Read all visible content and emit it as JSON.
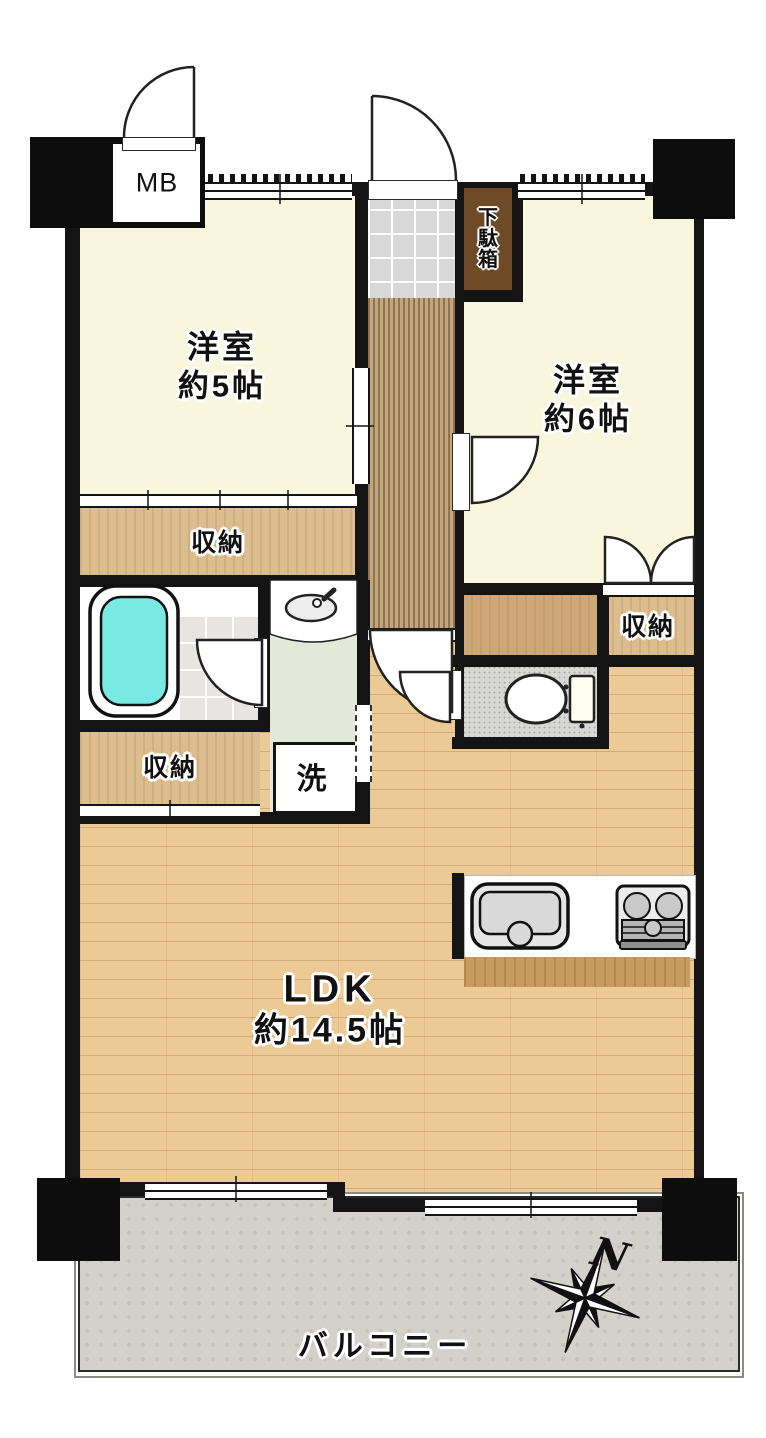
{
  "plan": {
    "title": "2LDK apartment floor plan",
    "mb_label": "MB",
    "entrance": {
      "shoe_cabinet_label": "下駄箱"
    },
    "rooms": {
      "west_room_5": {
        "name": "洋室",
        "size": "約5帖"
      },
      "west_room_6": {
        "name": "洋室",
        "size": "約6帖"
      },
      "ldk": {
        "name": "LDK",
        "size": "約14.5帖"
      },
      "laundry_label": "洗",
      "balcony_label": "バルコニー"
    },
    "storage": {
      "closet_under_room5": "収納",
      "closet_room6": "収納",
      "closet_under_bath": "収納"
    },
    "compass": {
      "north_label": "N"
    },
    "colors": {
      "wall": "#141414",
      "room_cream": "#f8f6dc",
      "closet_wood": "#dcbd90",
      "ldk_wood": "#ecca96",
      "hall_wood": "#c3a87e",
      "entry_tile": "#d8d8d8",
      "bath_water": "#79e9e4",
      "washroom_green": "#e2e9d8",
      "balcony_gray": "#d2d2cb",
      "shoe_cabinet_brown": "#6f4a26"
    }
  }
}
